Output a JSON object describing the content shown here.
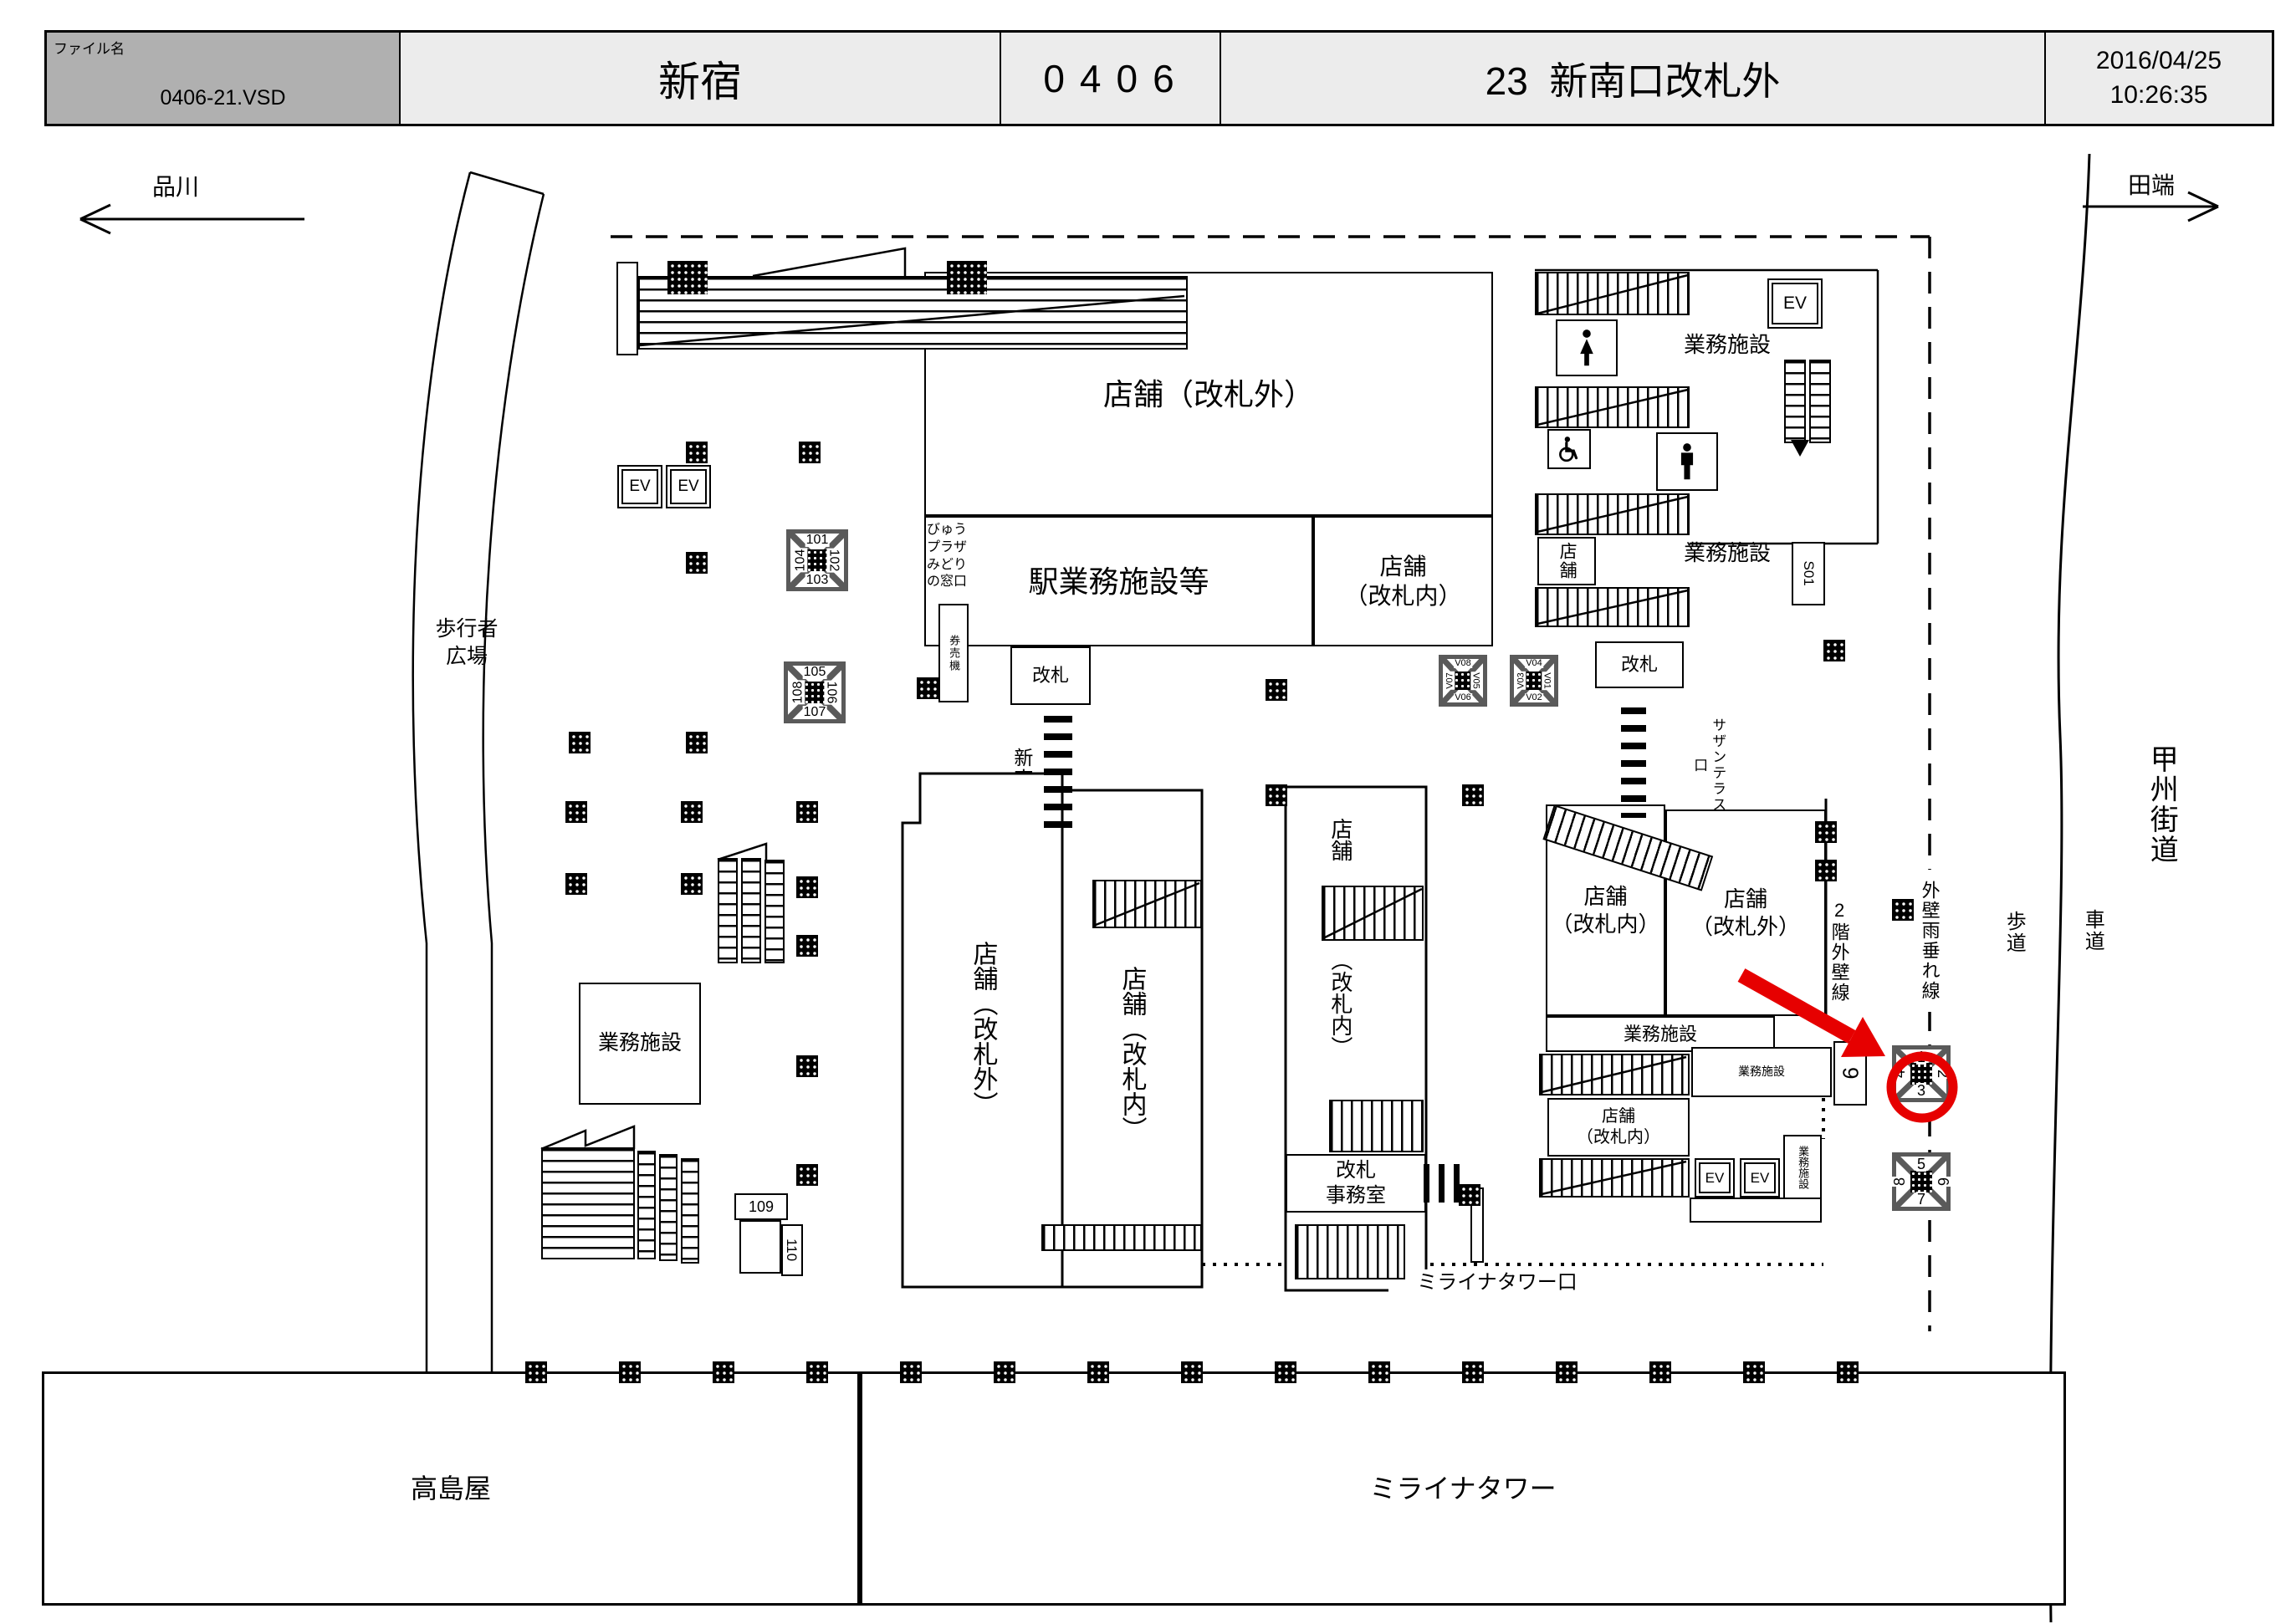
{
  "header": {
    "file_label": "ファイル名",
    "file_name": "0406-21.VSD",
    "station_name": "新宿",
    "station_code": "0406",
    "sheet_title": "23  新南口改札外",
    "date": "2016/04/25",
    "time": "10:26:35"
  },
  "directions": {
    "left": "品川",
    "right": "田端"
  },
  "roads": {
    "highway": "甲州街道",
    "sidewalk": "歩道",
    "roadway": "車道"
  },
  "lines": {
    "wall_2f": "2階外壁線",
    "rain_drip": "外壁雨垂れ線"
  },
  "plaza": {
    "pedestrian": "歩行者\n広場"
  },
  "buildings": {
    "takashimaya": "高島屋",
    "miraina_tower": "ミライナタワー",
    "miraina_exit": "ミライナタワー口"
  },
  "rooms": {
    "shop_outside_top": "店舗（改札外）",
    "station_office": "駅業務施設等",
    "shop_inside_top": "店舗\n（改札内）",
    "view_plaza": "びゅう\nプラザ\nみどり\nの窓口",
    "ticket_machine": "券売機",
    "gate_south": "改札",
    "new_south_exit": "新南口",
    "gate_right": "改札",
    "southern_terrace_exit": "サザンテラス口",
    "office_tr1": "業務施設",
    "office_tr2": "業務施設",
    "shop_small_right": "店舗",
    "s01": "S01",
    "shop_outside_tall": "店舗（改札外）",
    "shop_inside_tall": "店舗（改札内）",
    "shop_tall_right_top": "店舗",
    "shop_tall_right_sub": "（改札内）",
    "gate_office": "改札\n事務室",
    "office_left_sq": "業務施設",
    "shop_inside_r1": "店舗\n（改札内）",
    "shop_outside_r": "店舗\n（改札外）",
    "office_strip1": "業務施設",
    "office_strip2": "業務施設",
    "shop_inside_r2": "店舗\n（改札内）",
    "office_vert": "業務施設",
    "unit_109": "109",
    "unit_110": "110",
    "ev": "EV"
  },
  "pillar_labels": {
    "g101": {
      "top": "101",
      "right": "102",
      "bottom": "103",
      "left": "104"
    },
    "g105": {
      "top": "105",
      "right": "106",
      "bottom": "107",
      "left": "108"
    },
    "gv_left": {
      "top": "V08",
      "right": "V05",
      "bottom": "V06",
      "left": "V07"
    },
    "gv_right": {
      "top": "V04",
      "right": "V01",
      "bottom": "V02",
      "left": "V03"
    },
    "spot_a": {
      "top": "1",
      "right": "2",
      "bottom": "3",
      "left": "4"
    },
    "spot_b": {
      "top": "5",
      "right": "6",
      "bottom": "7",
      "left": "8"
    },
    "spot_9": "9"
  },
  "colors": {
    "highlight": "#e60000",
    "header_file_bg": "#b0b0b0"
  }
}
